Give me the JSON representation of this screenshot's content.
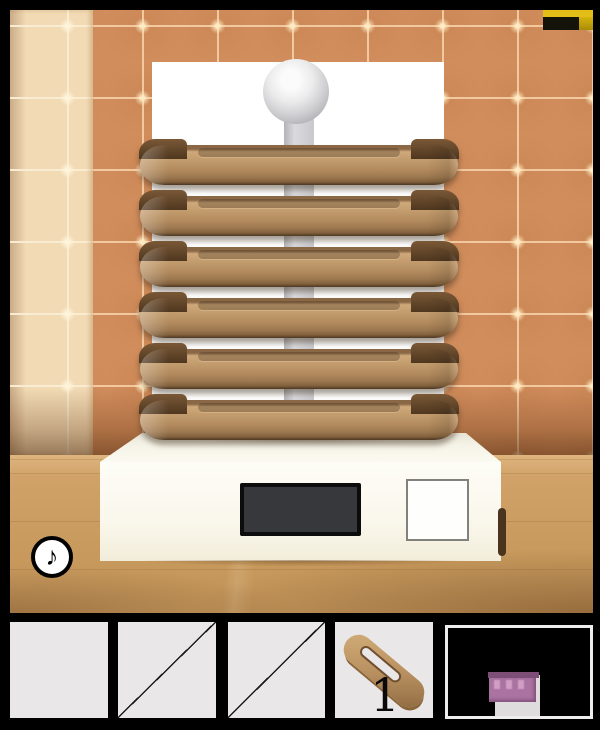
{
  "scene": {
    "music_button_glyph": "♪",
    "scale_display_value": ""
  },
  "palette": {
    "tile_orange": "#d18d5c",
    "tile_cream": "#f1dab4",
    "tile_grout": "#f2c99e",
    "wood_floor": "#c89a5d",
    "ring_brown": "#b58a5c",
    "base_white": "#fbf9f0",
    "pole_gray": "#d2d2d6",
    "accent_yellow": "#e3be17",
    "plaque_purple": "#aa73a2",
    "display_dark": "#36383b"
  },
  "inventory": {
    "slots": [
      {
        "id": "slot-1",
        "state": "empty"
      },
      {
        "id": "slot-2",
        "state": "crossed-out"
      },
      {
        "id": "slot-3",
        "state": "crossed-out"
      },
      {
        "id": "slot-4",
        "state": "item",
        "item": "wooden-ring",
        "count_label": "1"
      },
      {
        "id": "slot-5",
        "state": "item-viewer",
        "item": "purple-plaque"
      }
    ]
  }
}
